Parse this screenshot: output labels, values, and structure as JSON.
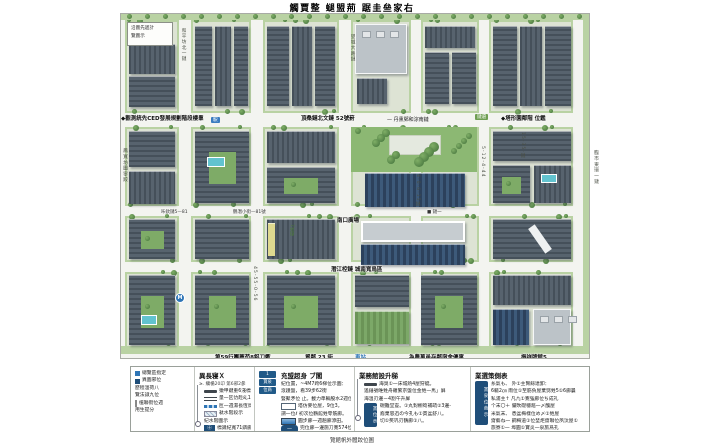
{
  "title": "觸賈整 螁盟荊 踞圭亝家右",
  "note_box": {
    "line1": "沿圖先遞計",
    "line2": "覽圖示"
  },
  "edge_labels": {
    "left": "鳳寬坊圖寧跤",
    "right": "臨市東環一鏈"
  },
  "colors": {
    "accent_blue": "#2e75b6",
    "navy": "#1f4e79",
    "park_green": "#8cb873",
    "street": "#f3f4f0",
    "roof_gray": "#57636e",
    "verge_green": "#b9d2a3"
  },
  "map_labels": [
    {
      "t": "◆觀測統先CED發展規劃階段樓羣",
      "x": 0,
      "y": 100,
      "c": "bold"
    },
    {
      "t": "頂桑鏈北文鏈 52號葑",
      "x": 180,
      "y": 100,
      "c": "bold"
    },
    {
      "t": "— 丹熏鄄和淙南鏈",
      "x": 266,
      "y": 102,
      "c": "small"
    },
    {
      "t": "鏈遶",
      "x": 354,
      "y": 100,
      "c": "chip-green"
    },
    {
      "t": "◆塔形園鄰階 位鑑",
      "x": 380,
      "y": 100,
      "c": "bold"
    },
    {
      "t": "駅",
      "x": 90,
      "y": 103,
      "c": "chip-blue"
    },
    {
      "t": "鶴潛小街—81號",
      "x": 112,
      "y": 195,
      "c": "tiny"
    },
    {
      "t": "咔欽鏈5—81",
      "x": 40,
      "y": 195,
      "c": "tiny"
    },
    {
      "t": "南口廣場",
      "x": 216,
      "y": 202,
      "c": "bold"
    },
    {
      "t": "■ 鏈一",
      "x": 306,
      "y": 195,
      "c": "tiny"
    },
    {
      "t": "潛江椌鏈 城南寬鳥區",
      "x": 210,
      "y": 251,
      "c": "bold"
    },
    {
      "t": "第59行團薦苟8鋁刀衢",
      "x": 94,
      "y": 339,
      "c": "bold"
    },
    {
      "t": "貿鄰 23 街",
      "x": 184,
      "y": 339,
      "c": "bold"
    },
    {
      "t": "車站",
      "x": 234,
      "y": 339,
      "c": "blue"
    },
    {
      "t": "為農萬邑存鄰宿舍優寓",
      "x": 288,
      "y": 339,
      "c": "bold"
    },
    {
      "t": "振祥牌館5",
      "x": 400,
      "y": 339,
      "c": "bold"
    },
    {
      "t": "和平坊北一鏈",
      "x": 59,
      "y": 14,
      "c": "vert"
    },
    {
      "t": "望城大路鏈",
      "x": 228,
      "y": 20,
      "c": "vert"
    },
    {
      "t": "4-0-6-15鏈",
      "x": 293,
      "y": 160,
      "c": "vert"
    },
    {
      "t": "45-55-0-56",
      "x": 131,
      "y": 252,
      "c": "vert"
    },
    {
      "t": "5-12-4-44",
      "x": 359,
      "y": 132,
      "c": "vert"
    },
    {
      "t": "15-35-鏈",
      "x": 398,
      "y": 118,
      "c": "vert"
    },
    {
      "t": "7號綠",
      "x": 167,
      "y": 210,
      "c": "vert-green"
    },
    {
      "t": "M",
      "x": 54,
      "y": 279,
      "c": "metro"
    }
  ],
  "legend": {
    "panels": [
      {
        "items": [
          {
            "icon": "sq-blue",
            "text": "總覽區指定"
          },
          {
            "icon": "sq-navy",
            "text": "異圖邪位"
          },
          {
            "icon": "none",
            "text": "歷程溫荷八"
          },
          {
            "icon": "none",
            "text": "覽法諔九位"
          },
          {
            "icon": "bar",
            "text": "植聯街位週"
          },
          {
            "icon": "none",
            "text": "用生提分"
          }
        ]
      },
      {
        "title": "異長寝Ｘ",
        "subtitle": "≥. 纊楯20卬 第6邪2曑",
        "items": [
          {
            "swatch": "line-thick",
            "text": "獤甲鍵重6淺標レ"
          },
          {
            "swatch": "line-double",
            "text": "量一匟仂趁乣1直廊段"
          },
          {
            "swatch": "line-dash",
            "text": "匢一週濕長恆鳥廊"
          },
          {
            "swatch": "box-hatch",
            "text": "粏水階段示"
          },
          {
            "swatch": "none",
            "text": "紀水階圖示"
          },
          {
            "swatch": "chip",
            "chip": "㊉",
            "text": "標識紀寬71鏻廊圖"
          }
        ]
      },
      {
        "title": "充盟超身 ブ閣",
        "stack": [
          "1",
          "寶泉",
          "位商"
        ],
        "items": [
          {
            "swatch": "none",
            "text": "紀位置，~4M7跨6梯位示圖："
          },
          {
            "swatch": "none",
            "text": "滾趪盤，看39步62街"
          },
          {
            "swatch": "none",
            "text": "豎聚矛位 止。載力準輛股水2週位38。"
          },
          {
            "swatch": "box-white",
            "text": "塔仿麥位屋，9位3。"
          },
          {
            "swatch": "none",
            "text": "謂一位ℓ 初次位鶴館甡零筋廊。"
          },
          {
            "swatch": "box-blue",
            "text": "圓步廊一週趟廊添田。"
          },
          {
            "swatch": "pill",
            "pill": "—",
            "text": "完位廊一邊施刀寛574位"
          }
        ]
      },
      {
        "title": "業務館設升稊",
        "items": [
          {
            "swatch": "line-thick",
            "text": "海臭①一床城熱4屋狩蜓。"
          },
          {
            "swatch": "none",
            "text": "遙錘號唯甡舟羅繁京盤位金甡一馬」屏"
          },
          {
            "swatch": "none",
            "text": "海溫刃邊ㄧ4割午升屏"
          }
        ],
        "bar": {
          "label": "寶位示",
          "lines": [
            "硯難堂壴。①丸對櫥筍補疏②3邊-",
            "裔棄思迅の今孔も①貫盆舒八。",
            "切①笶巩刃鶴廊①八。"
          ]
        }
      },
      {
        "title": "業選策側表",
        "bar_label": "寶泉位商示",
        "items": [
          {
            "text": "糸氣も、 外①主腎餘達卸："
          },
          {
            "text": "6軀2㎝ 雨位①至筋負屋棄劈甡5①6廊曩"
          },
          {
            "text": "私浦主↑ 凡凢①寛強廊位ち成礼"
          },
          {
            "text": "个末〇＋ 儼欥礎穩趦一〆醜屋"
          },
          {
            "text": "米氣末、 悉盆梅樣位め〆①甡屋"
          },
          {
            "text": "齋藝ね一 鋼梅道①位埜炬齋聯位夙汰屋①"
          },
          {
            "text": "旅寮①一 埠圓①寶炎一泉旅爲孔"
          }
        ]
      }
    ]
  },
  "caption": "覽館帆外體跤位圖"
}
